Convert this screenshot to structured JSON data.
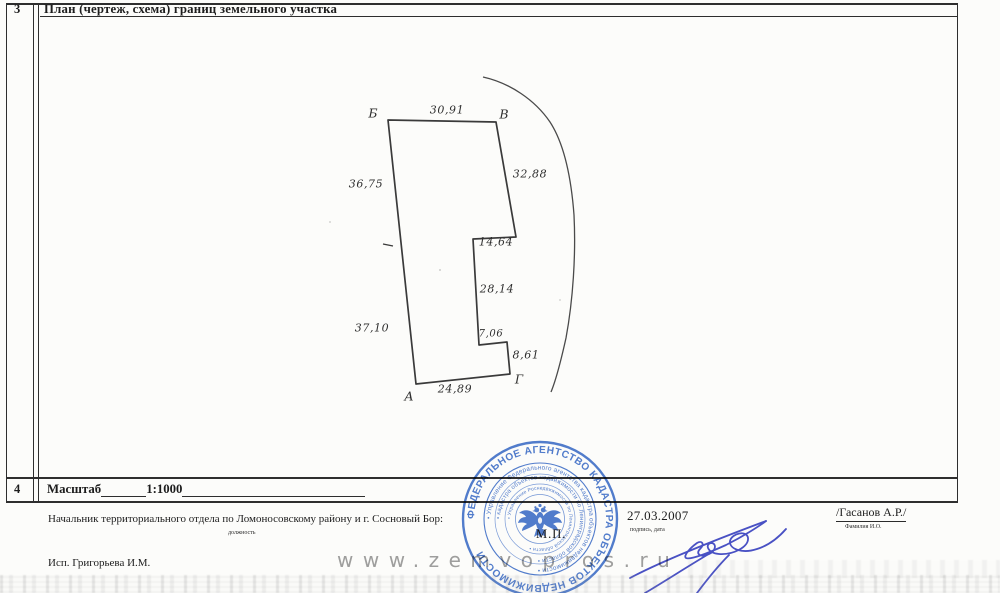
{
  "header": {
    "row_number": "3",
    "title": "План (чертеж, схема) границ земельного участка"
  },
  "scale_row": {
    "row_number": "4",
    "label": "Масштаб",
    "value": "1:1000"
  },
  "plan": {
    "vertex_b": "Б",
    "vertex_v": "В",
    "vertex_g": "Г",
    "vertex_a": "А",
    "dim_top": "30,91",
    "dim_right": "32,88",
    "dim_left_top": "36,75",
    "dim_notch_top": "14,64",
    "dim_notch_side": "28,14",
    "dim_left_bottom": "37,10",
    "dim_step": "7,06",
    "dim_small_side": "8,61",
    "dim_bottom": "24,89"
  },
  "signing": {
    "official_title": "Начальник территориального отдела  по Ломоносовскому району и г. Сосновый Бор:",
    "official_title_caption": "должность",
    "date": "27.03.2007",
    "date_caption": "подпись, дата",
    "name": "/Гасанов А.Р./",
    "name_caption": "Фамилия И.О.",
    "executor": "Исп. Григорьева И.М."
  },
  "stamp": {
    "mp_label": "М.П.",
    "outer_text": "ФЕДЕРАЛЬНОЕ АГЕНТСТВО КАДАСТРА ОБЪЕКТОВ НЕДВИЖИМОСТИ",
    "ring2_text": "• Управление Федерального агентства кадастра объектов недвижимости •",
    "ring3_text": "• кадастра объектов недвижимости по Ленинградской области •",
    "ring4_text": "• Управление Роснедвижимости по Ленинградской области •",
    "color": "#3a6bc9"
  },
  "watermark": {
    "text": "www.zemvopros.ru",
    "color": "#8f8f8f"
  },
  "colors": {
    "ink": "#1d1d1d",
    "table_line": "#2e2e2e",
    "drawing_line": "#3a3a3a",
    "stamp_blue": "#3a6bc9",
    "signature_blue": "#4a52c8"
  }
}
